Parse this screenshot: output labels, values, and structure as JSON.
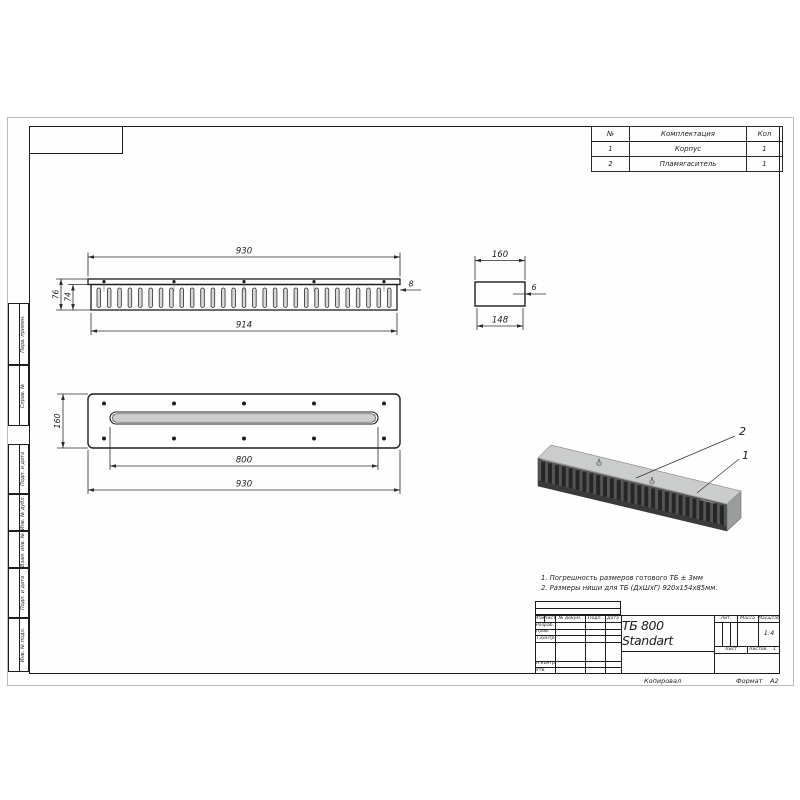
{
  "drawing": {
    "designation": "ТБ 800 Standart",
    "notes": [
      "1. Погрешность размеров готового ТБ ± 3мм",
      "2. Размеры ниши для ТБ (ДхШхГ) 920х154х85мм."
    ]
  },
  "parts_table": {
    "headers": [
      "№",
      "Комплектация",
      "Кол"
    ],
    "rows": [
      {
        "num": "1",
        "name": "Корпус",
        "qty": "1"
      },
      {
        "num": "2",
        "name": "Пламягаситель",
        "qty": "1"
      }
    ]
  },
  "front_view": {
    "dim_width_outer": "930",
    "dim_width_inner": "914",
    "dim_height_outer": "76",
    "dim_height_inner": "74",
    "dim_plate": "8",
    "slot_count": 29,
    "screw_count": 5
  },
  "side_view": {
    "dim_width_outer": "160",
    "dim_width_inner": "148",
    "dim_wall": "6"
  },
  "plan_view": {
    "dim_depth": "160",
    "dim_slot": "800",
    "dim_width": "930",
    "hole_cols": 5,
    "hatch_from": 113,
    "hatch_to": 375
  },
  "iso_view": {
    "callout_body": "1",
    "callout_flame_arrester": "2",
    "slat_count": 27
  },
  "title_block": {
    "header_cols": [
      "Изм.",
      "Лист",
      "№ докум.",
      "Подп.",
      "Дата"
    ],
    "role_rows": [
      "Разраб.",
      "Пров.",
      "Т.контр.",
      "Н.контр.",
      "Утв."
    ],
    "lit_label": "Лит.",
    "mass_label": "Масса",
    "scale_label": "Масштаб",
    "scale_value": "1:4",
    "sheet_label": "Лист",
    "sheets_label": "Листов",
    "sheets_value": "1",
    "copied_label": "Копировал",
    "format_label": "Формат",
    "format_value": "А2"
  },
  "margin_columns": [
    {
      "label": "Перв. примен.",
      "top": 185,
      "height": 62
    },
    {
      "label": "Справ. №",
      "top": 247,
      "height": 61
    },
    {
      "label": "Подп. и дата",
      "top": 326,
      "height": 50
    },
    {
      "label": "Инв. № дубл.",
      "top": 376,
      "height": 37
    },
    {
      "label": "Взам. инв. №",
      "top": 413,
      "height": 37
    },
    {
      "label": "Подп. и дата",
      "top": 450,
      "height": 50
    },
    {
      "label": "Инв. № подл.",
      "top": 500,
      "height": 54
    }
  ],
  "colors": {
    "line": "#1d1d1d",
    "dim": "#2a2a2a",
    "iso_top": "#cbcdcd",
    "iso_front": "#555555",
    "iso_slot": "#262626",
    "iso_end": "#9a9d9d"
  }
}
